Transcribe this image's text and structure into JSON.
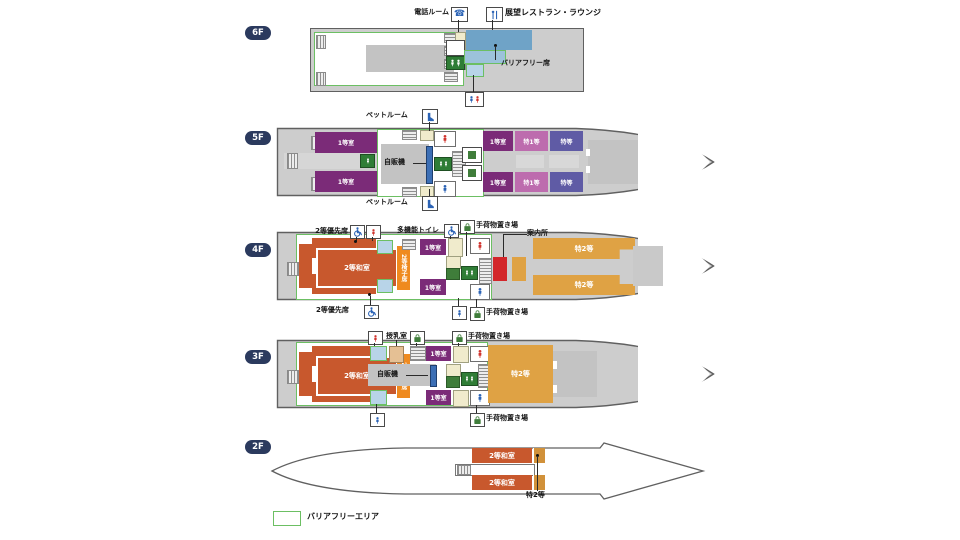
{
  "title": "船内デッキ案内図",
  "colors": {
    "badge": "#2b3a5e",
    "hull_fill": "#cdcdcd",
    "hull_stroke": "#606060",
    "barrier_green": "#6cbf63",
    "first": "#7b2b78",
    "sp1": "#bd6cae",
    "deluxe": "#5f5ba5",
    "tatami2": "#c8582d",
    "chair2": "#ef8a1f",
    "sp2": "#dfa244",
    "sp2_dark": "#d1913a",
    "info": "#d3262a",
    "rest_blue": "#6fa3c7",
    "seat_blue": "#9cc2da",
    "toiletF": "#d1342e",
    "toiletM": "#2b63b5",
    "elev": "#2f7d36",
    "vend": "#3c6fb5",
    "nursing": "#e5c094",
    "cream": "#f0ebcc",
    "boxblue": "#b8d4e8",
    "bag": "#3f7d3a"
  },
  "legend": {
    "barrier_free": "バリアフリーエリア"
  },
  "floors": [
    {
      "badge": "6F",
      "features": [
        "電話ルーム",
        "展望レストラン・ラウンジ",
        "バリアフリー席"
      ]
    },
    {
      "badge": "5F",
      "features": [
        "ペットルーム",
        "1等室",
        "自販機",
        "特1等",
        "特等"
      ]
    },
    {
      "badge": "4F",
      "features": [
        "2等優先席",
        "多機能トイレ",
        "手荷物置き場",
        "案内所",
        "2等和室",
        "2等椅子席",
        "自販機",
        "1等室",
        "特2等"
      ]
    },
    {
      "badge": "3F",
      "features": [
        "授乳室",
        "手荷物置き場",
        "2等和室",
        "2等椅子席",
        "自販機",
        "1等室",
        "特2等"
      ]
    },
    {
      "badge": "2F",
      "features": [
        "2等和室",
        "特2等"
      ]
    }
  ],
  "labels": {
    "phone_room": "電話ルーム",
    "restaurant_lounge": "展望レストラン・ラウンジ",
    "barrier_free_seat": "バリアフリー席",
    "pet_room": "ペットルーム",
    "first_class": "1等室",
    "special_first": "特1等",
    "deluxe": "特等",
    "vending": "自販機",
    "priority_2nd": "2等優先席",
    "multi_toilet": "多機能トイレ",
    "luggage": "手荷物置き場",
    "info_desk": "案内所",
    "tatami_2nd": "2等和室",
    "chair_2nd": "2等椅子席",
    "special_2nd": "特2等",
    "nursing_room": "授乳室"
  }
}
